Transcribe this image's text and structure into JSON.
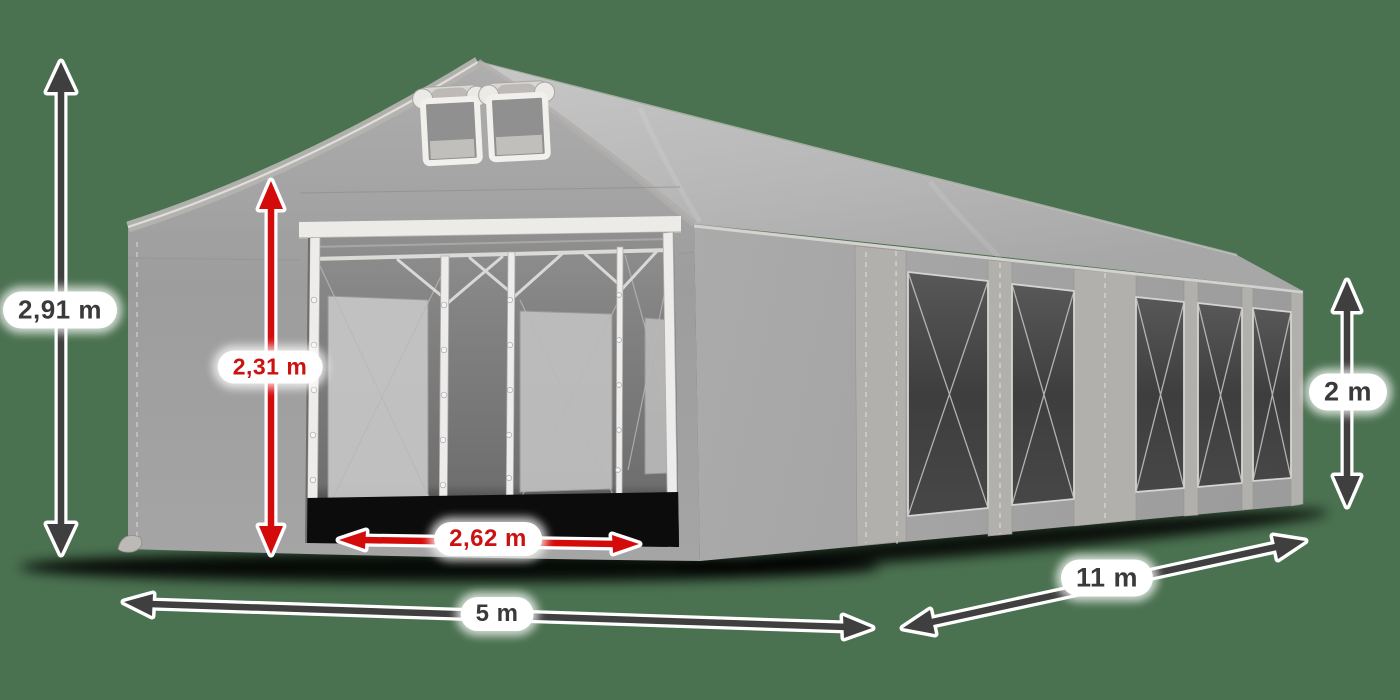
{
  "scene": {
    "background_color": "#4a7150",
    "description": "Grey marquee party tent illustration annotated with dimension arrows"
  },
  "dimensions": {
    "total_height": {
      "value": "2,91 m",
      "accent": "dark"
    },
    "entrance_height": {
      "value": "2,31 m",
      "accent": "red"
    },
    "entrance_width": {
      "value": "2,62 m",
      "accent": "red"
    },
    "front_width": {
      "value": "5 m",
      "accent": "dark"
    },
    "side_length": {
      "value": "11 m",
      "accent": "dark"
    },
    "side_wall_height": {
      "value": "2 m",
      "accent": "dark"
    }
  },
  "tent": {
    "side_window_count": 5,
    "front_vent_count": 2,
    "colors": {
      "canvas": "#a3a3a3",
      "roof": "#bcbcbc",
      "window_dark": "#434343",
      "frame_white": "#eceae7"
    }
  },
  "annotation_colors": {
    "arrow_dark": "#3f3f3f",
    "arrow_red": "#d40b0b",
    "text_dark": "#3a3a3a",
    "text_red": "#cc1111",
    "label_background": "#ffffff"
  }
}
